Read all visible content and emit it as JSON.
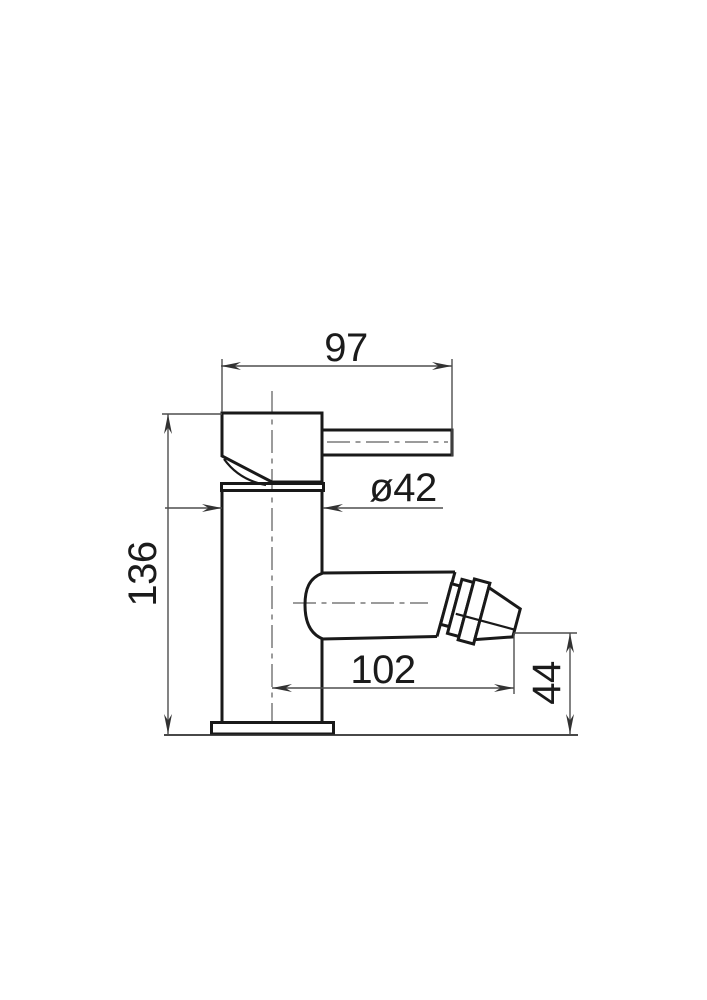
{
  "drawing": {
    "subject": "Technical dimension drawing: single-lever monobloc mixer tap, side elevation",
    "background_color": "#ffffff",
    "outline_color": "#191919",
    "dimension_line_color": "#4e4e4e",
    "text_color": "#1b1b1b",
    "labels": {
      "lever_reach": "97",
      "body_diameter": "ø42",
      "overall_height": "136",
      "spout_reach": "102",
      "outlet_height": "44"
    }
  }
}
